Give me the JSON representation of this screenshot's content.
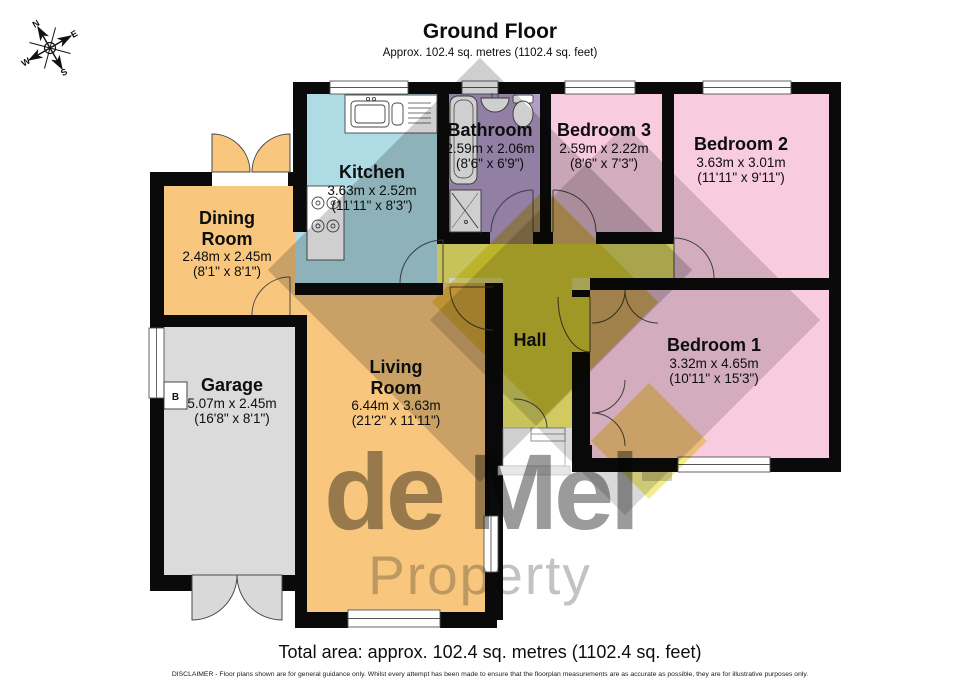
{
  "title": {
    "heading": "Ground Floor",
    "subtitle": "Approx. 102.4 sq. metres (1102.4 sq. feet)"
  },
  "footer": {
    "total_area": "Total area: approx. 102.4 sq. metres (1102.4 sq. feet)",
    "disclaimer": "DISCLAIMER -  Floor plans shown are for general guidance only. Whilst every attempt has been made to ensure that the floorplan measurements are as accurate as possible, they are for illustrative purposes only."
  },
  "watermark": {
    "line1": "de Mel",
    "line2": "Property"
  },
  "compass": {
    "n": "N",
    "e": "E",
    "s": "S",
    "w": "W"
  },
  "garage_appliance_label": "B",
  "rooms": [
    {
      "id": "kitchen",
      "name": "Kitchen",
      "metric": "3.63m x 2.52m",
      "imperial": "(11'11\" x 8'3\")",
      "color": "#aedbe4"
    },
    {
      "id": "bathroom",
      "name": "Bathroom",
      "metric": "2.59m x 2.06m",
      "imperial": "(8'6\" x 6'9\")",
      "color": "#b49dca"
    },
    {
      "id": "bedroom-3",
      "name": "Bedroom 3",
      "metric": "2.59m x 2.22m",
      "imperial": "(8'6\" x 7'3\")",
      "color": "#f8cbdf"
    },
    {
      "id": "bedroom-2",
      "name": "Bedroom 2",
      "metric": "3.63m x 3.01m",
      "imperial": "(11'11\" x 9'11\")",
      "color": "#f8cbdf"
    },
    {
      "id": "bedroom-1",
      "name": "Bedroom 1",
      "metric": "3.32m x 4.65m",
      "imperial": "(10'11\" x 15'3\")",
      "color": "#f8cbdf"
    },
    {
      "id": "hall",
      "name": "Hall",
      "color": "#f6ef6f"
    },
    {
      "id": "living-room",
      "name": "Living Room",
      "metric": "6.44m x 3.63m",
      "imperial": "(21'2\" x 11'11\")",
      "color": "#f8c77d"
    },
    {
      "id": "dining-room",
      "name": "Dining Room",
      "metric": "2.48m x 2.45m",
      "imperial": "(8'1\" x 8'1\")",
      "color": "#f8c77d"
    },
    {
      "id": "garage",
      "name": "Garage",
      "metric": "5.07m x 2.45m",
      "imperial": "(16'8\" x 8'1\")",
      "color": "#dbdbdb"
    }
  ],
  "colors": {
    "wall": "#0a0a0a",
    "window": "#ffffff",
    "door_arc": "#4a4a4a",
    "watermark_gray": "#808080",
    "watermark_yellow": "#e9df2c",
    "garage_door": "#d9d9d9"
  }
}
